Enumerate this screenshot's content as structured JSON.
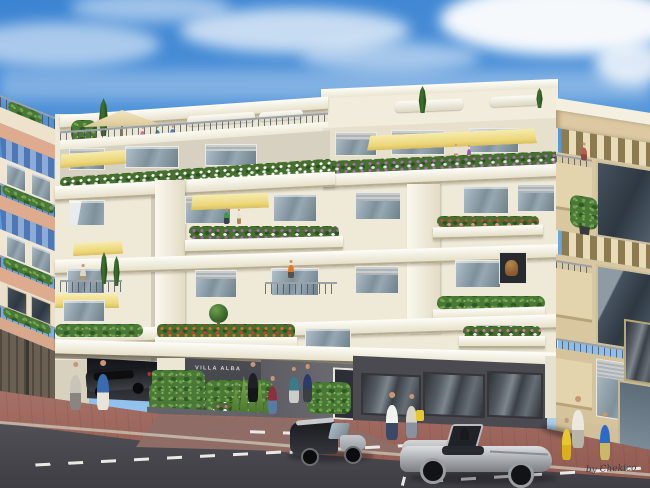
{
  "meta": {
    "type": "architectural-rendering",
    "subject": "Modern residential building street elevation with neighbors, pedestrians and cars"
  },
  "building": {
    "sign_text": "VILLA ALBA",
    "floors_visible": 6,
    "features": [
      "roof terrace with parasol",
      "yellow awnings",
      "planted balconies",
      "garage entry",
      "glass storefront",
      "entrance walkway"
    ]
  },
  "signature": {
    "text": "by Chekico"
  },
  "neighbors": {
    "left": "pink-banded building with blue striped awnings and garage doors",
    "right": "beige building with brown striped awnings and glass door"
  },
  "street": {
    "vehicles": [
      "dark sedan entering garage",
      "black smart city car",
      "silver convertible roadster"
    ],
    "markings": "white dashed parking-lane lines",
    "sidewalk": "red-brown pavers"
  },
  "people": {
    "on_street": 11,
    "on_balconies": 9,
    "on_roof_terrace": 3
  },
  "palette": {
    "sky_blue": "#3c84d2",
    "cloud_white": "#ffffff",
    "building_cream": "#f1ecdb",
    "slab_white": "#fefdf8",
    "awning_yellow": "#ecd678",
    "awning_blue": "#4f77b5",
    "awning_stripe_brown": "#8c7a50",
    "left_building_pink": "#dfab8e",
    "right_building_beige": "#d9c7a0",
    "foliage_green": "#4a7836",
    "flower_purple": "#a868b8",
    "flower_orange": "#e07030",
    "sidewalk_red": "#9d6156",
    "road_grey": "#4a4a50",
    "ground_floor_grey": "#46464c",
    "car_silver": "#b9bcc0",
    "car_black": "#17181c"
  }
}
